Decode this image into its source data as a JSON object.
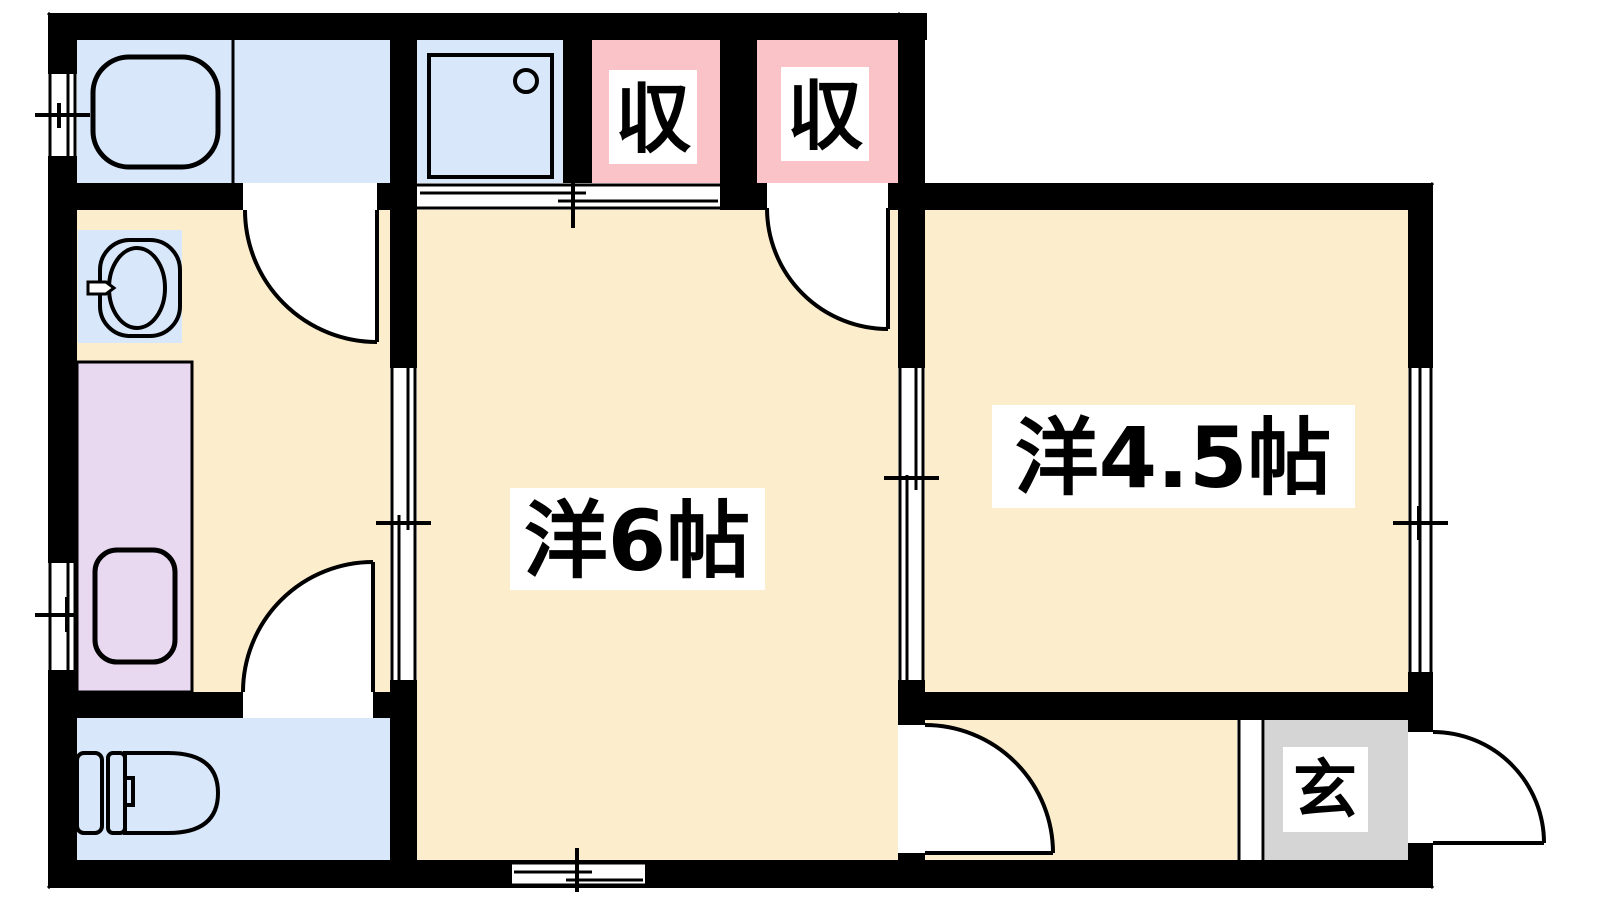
{
  "plan": {
    "type": "floor-plan",
    "rooms": {
      "western6": {
        "label": "洋6帖"
      },
      "western45": {
        "label": "洋4.5帖"
      },
      "closet1": {
        "label": "収"
      },
      "closet2": {
        "label": "収"
      },
      "entrance": {
        "label": "玄"
      }
    },
    "fixtures": [
      "bathtub",
      "shower-pan",
      "washbasin",
      "washing-machine-pan",
      "toilet"
    ]
  },
  "colors": {
    "wall": "#000000",
    "line": "#000000",
    "floor_wood": "#FCEECD",
    "floor_wet": "#D9E7FA",
    "floor_closet": "#F9C3C7",
    "floor_laundry": "#E8D8F0",
    "floor_entrance": "#D5D5D5",
    "opening": "#FFFFFF",
    "label_bg": "#FFFFFF",
    "text": "#000000"
  }
}
